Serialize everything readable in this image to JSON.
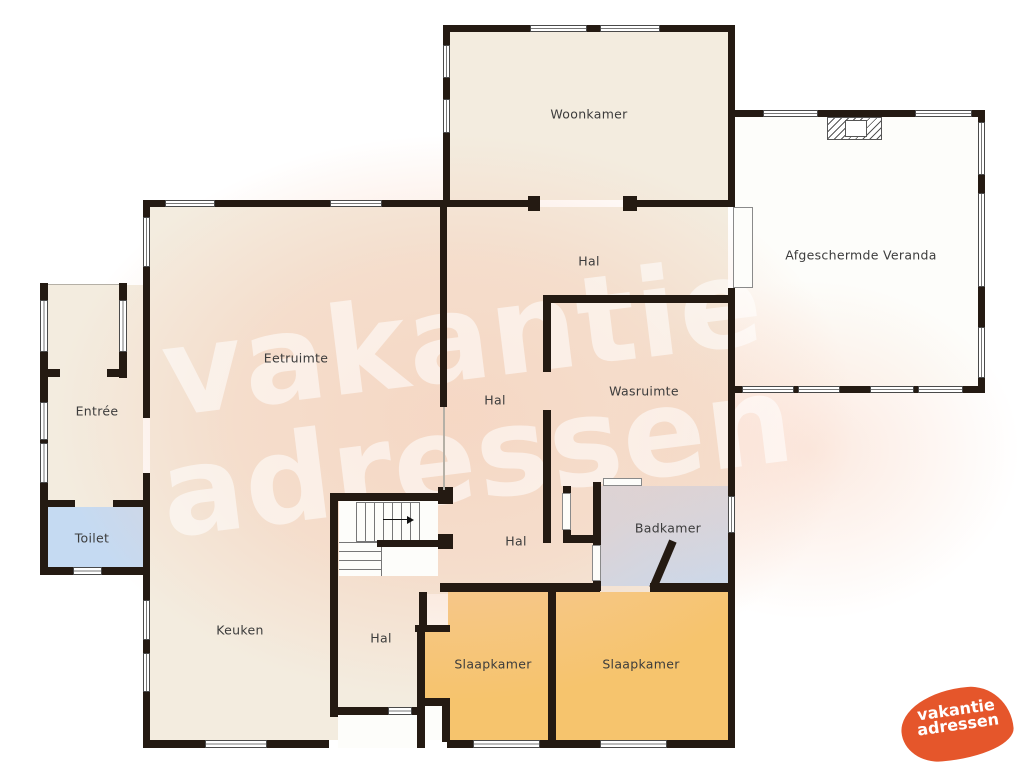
{
  "plan": {
    "rooms": {
      "woonkamer": "Woonkamer",
      "veranda": "Afgeschermde Veranda",
      "hal": "Hal",
      "eetruimte": "Eetruimte",
      "wasruimte": "Wasruimte",
      "entree": "Entrée",
      "toilet": "Toilet",
      "badkamer": "Badkamer",
      "keuken": "Keuken",
      "slaapkamer": "Slaapkamer"
    },
    "icons": {
      "door_swing_arrow": "left-triangle",
      "stairs_direction_arrow": "right-triangle"
    }
  },
  "watermark": {
    "line1": "vakantie",
    "line2": "adressen"
  },
  "logo": {
    "line1": "vakantie",
    "line2": "adressen"
  },
  "colors": {
    "wall": "#241a12",
    "floor": "#f3ecdf",
    "floor_tint": "#f7cbb4",
    "wet_room": "#c5daf2",
    "bedroom": "#f6c46d",
    "veranda": "#fdfdfa",
    "brand_orange": "#e5562b",
    "label_text": "#3c3c3c"
  }
}
